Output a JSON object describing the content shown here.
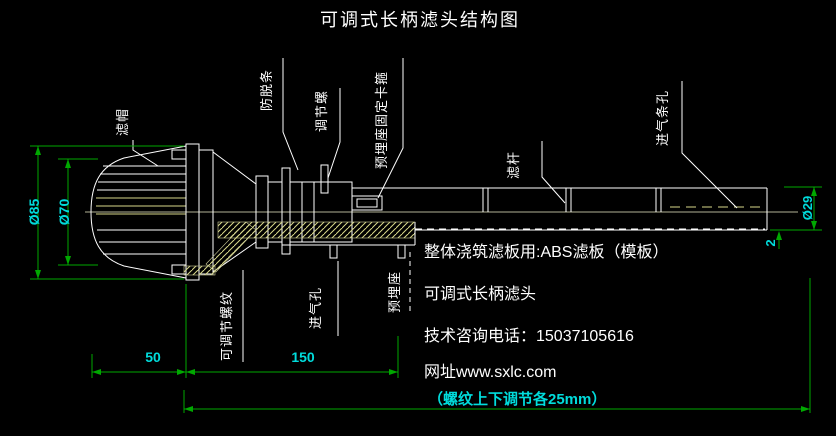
{
  "title": "可调式长柄滤头结构图",
  "colors": {
    "background": "#000000",
    "drawing_line": "#ffffff",
    "dimension_line": "#00a800",
    "dimension_text": "#00dcdc",
    "hatch": "#d8d88a",
    "centerline": "#eeeec8"
  },
  "part_labels": {
    "cap": "滤帽",
    "anti_slip_strip": "防脱条",
    "adjusting_screw": "调节螺",
    "embedded_seat_clamp": "预埋座固定卡箍",
    "filter_rod": "滤杆",
    "air_inlet_slots": "进气条孔",
    "adjustable_thread": "可调节螺纹",
    "air_inlet_hole": "进气孔",
    "embedded_seat": "预埋座"
  },
  "dimensions": {
    "cap_outer_diameter": "Ø85",
    "cap_inner_diameter": "Ø70",
    "rod_diameter": "Ø29",
    "wall_thickness": "2",
    "cap_length": "50",
    "body_length": "150",
    "adjustment_note": "（螺纹上下调节各25mm）"
  },
  "info": {
    "line1": "整体浇筑滤板用:ABS滤板（模板）",
    "line2": "可调式长柄滤头",
    "line3": "技术咨询电话：15037105616",
    "line4": "网址www.sxlc.com"
  }
}
